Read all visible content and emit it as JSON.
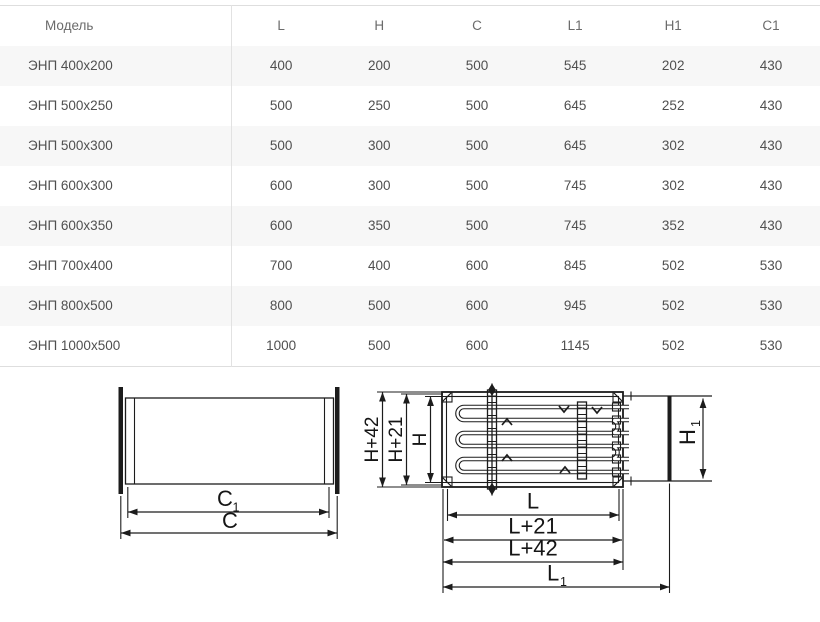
{
  "colors": {
    "row_stripe": "#f7f7f7",
    "table_border": "#dedede",
    "table_text": "#4f4f4f",
    "drawing_line": "#1c1c1c"
  },
  "table": {
    "columns": [
      "Модель",
      "L",
      "H",
      "C",
      "L1",
      "H1",
      "C1"
    ],
    "rows": [
      [
        "ЭНП 400x200",
        "400",
        "200",
        "500",
        "545",
        "202",
        "430"
      ],
      [
        "ЭНП 500x250",
        "500",
        "250",
        "500",
        "645",
        "252",
        "430"
      ],
      [
        "ЭНП 500x300",
        "500",
        "300",
        "500",
        "645",
        "302",
        "430"
      ],
      [
        "ЭНП 600x300",
        "600",
        "300",
        "500",
        "745",
        "302",
        "430"
      ],
      [
        "ЭНП 600x350",
        "600",
        "350",
        "500",
        "745",
        "352",
        "430"
      ],
      [
        "ЭНП 700x400",
        "700",
        "400",
        "600",
        "845",
        "502",
        "530"
      ],
      [
        "ЭНП 800x500",
        "800",
        "500",
        "600",
        "945",
        "502",
        "530"
      ],
      [
        "ЭНП 1000x500",
        "1000",
        "500",
        "600",
        "1145",
        "502",
        "530"
      ]
    ]
  },
  "drawings": {
    "duct": {
      "c1_main": "C",
      "c1_sub": "1",
      "c_label": "C"
    },
    "heater": {
      "h42": "H+42",
      "h21": "H+21",
      "h": "H",
      "h1_main": "H",
      "h1_sub": "1",
      "l": "L",
      "l21": "L+21",
      "l42": "L+42",
      "l1_main": "L",
      "l1_sub": "1"
    }
  }
}
